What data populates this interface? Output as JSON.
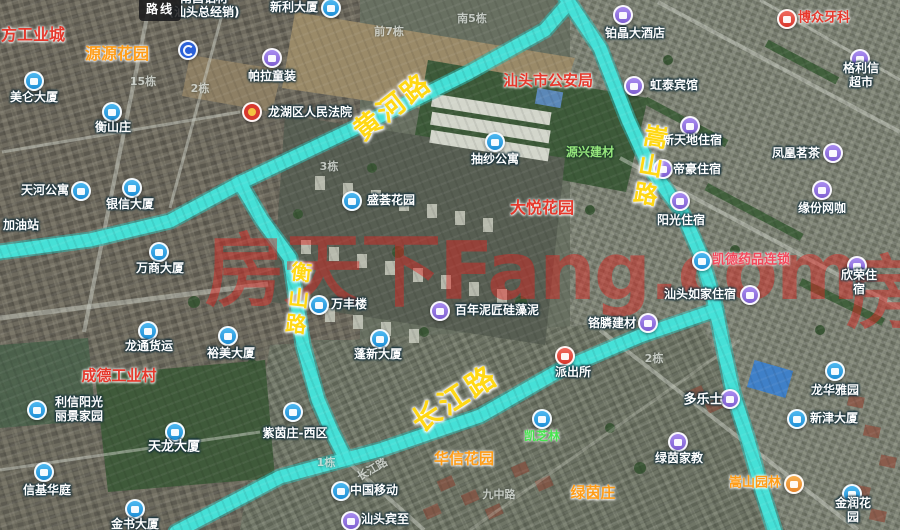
{
  "map": {
    "route_badge": "路线",
    "watermark_text": "房天下Fang.com",
    "watermark_partial": "房"
  },
  "colors": {
    "route_highlight": "#45e2d9",
    "road_label_yellow": "#ffd814",
    "poi_blue": "#2fa3e8",
    "poi_purple": "#9673e0",
    "poi_red": "#d8362c",
    "red_label": "#e6382c",
    "orange_label": "#ff9d18",
    "watermark_red": "#e4201c"
  },
  "road_labels": [
    {
      "id": "huanghe",
      "text": "黄河路",
      "x": 393,
      "y": 107,
      "rot": -38,
      "size": 27,
      "vertical": false
    },
    {
      "id": "songshan",
      "text": "嵩山路",
      "x": 648,
      "y": 167,
      "rot": 10,
      "size": 24,
      "vertical": true
    },
    {
      "id": "hengshan",
      "text": "衡山路",
      "x": 297,
      "y": 300,
      "rot": 6,
      "size": 21,
      "vertical": true
    },
    {
      "id": "changjiang",
      "text": "长江路",
      "x": 455,
      "y": 399,
      "rot": -33,
      "size": 29,
      "vertical": false
    }
  ],
  "markers": [
    {
      "x": 188,
      "y": 50,
      "c": "navy",
      "n": "u-turn-arrow"
    }
  ],
  "pois": [
    {
      "t": "南昌铝材\n(汕头总经销)",
      "x": 204,
      "y": 6,
      "k": "white"
    },
    {
      "t": "新利大厦",
      "x": 294,
      "y": 8,
      "k": "white",
      "icon": {
        "x": 331,
        "y": 8,
        "c": "blue"
      }
    },
    {
      "t": "博众牙科",
      "x": 824,
      "y": 19,
      "k": "red",
      "s": 13,
      "icon": {
        "x": 787,
        "y": 19,
        "c": "red",
        "n": "dental-clinic"
      }
    },
    {
      "t": "铂晶大酒店",
      "x": 635,
      "y": 34,
      "k": "white",
      "icon": {
        "x": 623,
        "y": 15,
        "c": "purple"
      }
    },
    {
      "t": "方工业城",
      "x": 33,
      "y": 35,
      "k": "red",
      "s": 16
    },
    {
      "t": "源源花园",
      "x": 117,
      "y": 54,
      "k": "orange",
      "s": 16
    },
    {
      "t": "帕拉童装",
      "x": 272,
      "y": 77,
      "k": "white",
      "icon": {
        "x": 272,
        "y": 58,
        "c": "purple"
      }
    },
    {
      "t": "格利信超市",
      "x": 861,
      "y": 76,
      "k": "white",
      "icon": {
        "x": 860,
        "y": 59,
        "c": "purple"
      }
    },
    {
      "t": "汕头市公安局",
      "x": 548,
      "y": 81,
      "k": "red",
      "s": 15
    },
    {
      "t": "虹泰宾馆",
      "x": 674,
      "y": 86,
      "k": "white",
      "icon": {
        "x": 634,
        "y": 86,
        "c": "purple"
      }
    },
    {
      "t": "美仑大厦",
      "x": 34,
      "y": 98,
      "k": "white",
      "icon": {
        "x": 34,
        "y": 81,
        "c": "blue"
      }
    },
    {
      "t": "龙湖区人民法院",
      "x": 310,
      "y": 113,
      "k": "white",
      "icon": {
        "x": 252,
        "y": 112,
        "c": "emblem",
        "n": "court-emblem"
      }
    },
    {
      "t": "衡山庄",
      "x": 113,
      "y": 128,
      "k": "white",
      "icon": {
        "x": 112,
        "y": 112,
        "c": "blue"
      }
    },
    {
      "t": "新天地住宿",
      "x": 692,
      "y": 141,
      "k": "white",
      "icon": {
        "x": 690,
        "y": 126,
        "c": "purple"
      }
    },
    {
      "t": "源兴建材",
      "x": 590,
      "y": 153,
      "k": "green"
    },
    {
      "t": "凤凰茗茶",
      "x": 796,
      "y": 154,
      "k": "white",
      "icon": {
        "x": 833,
        "y": 153,
        "c": "purple"
      }
    },
    {
      "t": "抽纱公寓",
      "x": 495,
      "y": 160,
      "k": "white",
      "icon": {
        "x": 495,
        "y": 142,
        "c": "blue"
      }
    },
    {
      "t": "帝豪住宿",
      "x": 697,
      "y": 170,
      "k": "white",
      "icon": {
        "x": 663,
        "y": 169,
        "c": "purple"
      }
    },
    {
      "t": "天河公寓",
      "x": 45,
      "y": 191,
      "k": "white",
      "icon": {
        "x": 81,
        "y": 191,
        "c": "blue"
      }
    },
    {
      "t": "盛荟花园",
      "x": 391,
      "y": 201,
      "k": "white",
      "icon": {
        "x": 352,
        "y": 201,
        "c": "blue"
      }
    },
    {
      "t": "银信大厦",
      "x": 130,
      "y": 205,
      "k": "white",
      "icon": {
        "x": 132,
        "y": 188,
        "c": "blue"
      }
    },
    {
      "t": "大悦花园",
      "x": 542,
      "y": 208,
      "k": "red",
      "s": 16
    },
    {
      "t": "缘份网咖",
      "x": 822,
      "y": 209,
      "k": "white",
      "icon": {
        "x": 822,
        "y": 190,
        "c": "purple"
      }
    },
    {
      "t": "阳光住宿",
      "x": 681,
      "y": 221,
      "k": "white",
      "icon": {
        "x": 680,
        "y": 201,
        "c": "purple"
      }
    },
    {
      "t": "加油站",
      "x": 21,
      "y": 226,
      "k": "white"
    },
    {
      "t": "凯德药品连锁",
      "x": 751,
      "y": 261,
      "k": "pink",
      "s": 13,
      "icon": {
        "x": 702,
        "y": 261,
        "c": "blue"
      }
    },
    {
      "t": "万商大厦",
      "x": 160,
      "y": 269,
      "k": "white",
      "icon": {
        "x": 159,
        "y": 252,
        "c": "blue"
      }
    },
    {
      "t": "欣荣住宿",
      "x": 859,
      "y": 283,
      "k": "white",
      "icon": {
        "x": 857,
        "y": 266,
        "c": "purple"
      }
    },
    {
      "t": "汕头如家住宿",
      "x": 700,
      "y": 295,
      "k": "white",
      "icon": {
        "x": 750,
        "y": 295,
        "c": "purple"
      }
    },
    {
      "t": "万丰楼",
      "x": 349,
      "y": 305,
      "k": "white",
      "icon": {
        "x": 319,
        "y": 305,
        "c": "blue"
      }
    },
    {
      "t": "百年泥匠硅藻泥",
      "x": 497,
      "y": 311,
      "k": "white",
      "icon": {
        "x": 440,
        "y": 311,
        "c": "purple"
      }
    },
    {
      "t": "铬膦建材",
      "x": 612,
      "y": 324,
      "k": "white",
      "icon": {
        "x": 648,
        "y": 323,
        "c": "purple"
      }
    },
    {
      "t": "龙通货运",
      "x": 149,
      "y": 347,
      "k": "white",
      "icon": {
        "x": 148,
        "y": 331,
        "c": "blue"
      }
    },
    {
      "t": "裕美大厦",
      "x": 231,
      "y": 354,
      "k": "white",
      "icon": {
        "x": 228,
        "y": 336,
        "c": "blue"
      }
    },
    {
      "t": "蓬新大厦",
      "x": 378,
      "y": 355,
      "k": "white",
      "icon": {
        "x": 380,
        "y": 339,
        "c": "blue"
      }
    },
    {
      "t": "派出所",
      "x": 573,
      "y": 373,
      "k": "white",
      "icon": {
        "x": 565,
        "y": 356,
        "c": "red",
        "n": "police-badge"
      }
    },
    {
      "t": "成德工业村",
      "x": 119,
      "y": 376,
      "k": "red",
      "s": 15
    },
    {
      "t": "龙华雅园",
      "x": 835,
      "y": 391,
      "k": "white",
      "icon": {
        "x": 835,
        "y": 371,
        "c": "blue"
      }
    },
    {
      "t": "多乐士",
      "x": 703,
      "y": 401,
      "k": "white",
      "s": 13,
      "icon": {
        "x": 730,
        "y": 399,
        "c": "purple"
      }
    },
    {
      "t": "利信阳光\n丽景家园",
      "x": 79,
      "y": 410,
      "k": "white",
      "icon": {
        "x": 37,
        "y": 410,
        "c": "blue"
      }
    },
    {
      "t": "新津大厦",
      "x": 834,
      "y": 419,
      "k": "white",
      "icon": {
        "x": 797,
        "y": 419,
        "c": "blue"
      }
    },
    {
      "t": "紫茵庄-西区",
      "x": 295,
      "y": 434,
      "k": "white",
      "icon": {
        "x": 293,
        "y": 412,
        "c": "blue"
      }
    },
    {
      "t": "凯芝林",
      "x": 542,
      "y": 437,
      "k": "lime",
      "icon": {
        "x": 542,
        "y": 419,
        "c": "blue"
      }
    },
    {
      "t": "天龙大厦",
      "x": 174,
      "y": 448,
      "k": "white",
      "s": 13,
      "icon": {
        "x": 175,
        "y": 432,
        "c": "blue"
      }
    },
    {
      "t": "华信花园",
      "x": 464,
      "y": 459,
      "k": "orange",
      "s": 15
    },
    {
      "t": "绿茵家教",
      "x": 679,
      "y": 459,
      "k": "white",
      "icon": {
        "x": 678,
        "y": 442,
        "c": "purple"
      }
    },
    {
      "t": "嵩山园林",
      "x": 755,
      "y": 484,
      "k": "orange",
      "s": 13,
      "icon": {
        "x": 794,
        "y": 484,
        "c": "orange"
      }
    },
    {
      "t": "信基华庭",
      "x": 47,
      "y": 491,
      "k": "white",
      "icon": {
        "x": 44,
        "y": 472,
        "c": "blue"
      }
    },
    {
      "t": "中国移动",
      "x": 374,
      "y": 491,
      "k": "white",
      "icon": {
        "x": 341,
        "y": 491,
        "c": "blue"
      }
    },
    {
      "t": "绿茵庄",
      "x": 593,
      "y": 493,
      "k": "orange",
      "s": 15
    },
    {
      "t": "金润花园",
      "x": 853,
      "y": 511,
      "k": "white",
      "icon": {
        "x": 852,
        "y": 494,
        "c": "blue"
      }
    },
    {
      "t": "汕头宾至",
      "x": 385,
      "y": 520,
      "k": "white",
      "icon": {
        "x": 351,
        "y": 521,
        "c": "purple"
      }
    },
    {
      "t": "金书大厦",
      "x": 135,
      "y": 525,
      "k": "white",
      "icon": {
        "x": 135,
        "y": 509,
        "c": "blue"
      }
    }
  ],
  "faint_labels": [
    {
      "t": "南5栋",
      "x": 472,
      "y": 18
    },
    {
      "t": "前7栋",
      "x": 389,
      "y": 31
    },
    {
      "t": "15栋",
      "x": 143,
      "y": 81
    },
    {
      "t": "2栋",
      "x": 200,
      "y": 88
    },
    {
      "t": "3栋",
      "x": 329,
      "y": 166
    },
    {
      "t": "2栋",
      "x": 654,
      "y": 358
    },
    {
      "t": "1栋",
      "x": 326,
      "y": 462
    },
    {
      "t": "长江路",
      "x": 372,
      "y": 469,
      "rot": -30
    },
    {
      "t": "九中路",
      "x": 499,
      "y": 494
    }
  ]
}
